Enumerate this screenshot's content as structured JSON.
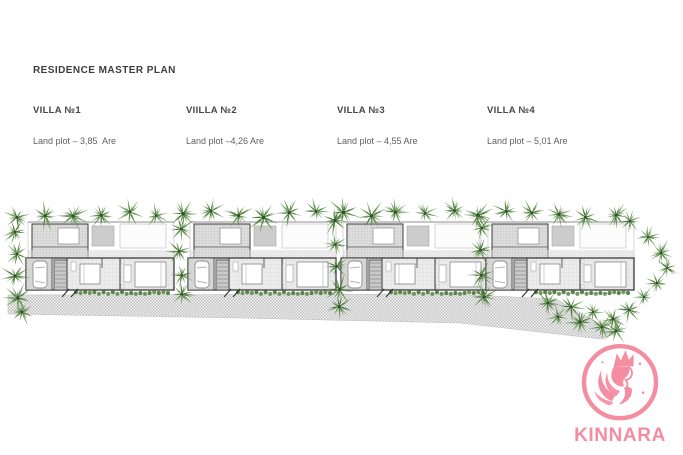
{
  "page": {
    "title": "RESIDENCE MASTER PLAN"
  },
  "villas": [
    {
      "name": "VILLA №1",
      "land_plot": "Land plot – 3,85  Are"
    },
    {
      "name": "VIILLA №2",
      "land_plot": "Land plot –4,26 Are"
    },
    {
      "name": "VILLA №3",
      "land_plot": "Land plot – 4,55 Are"
    },
    {
      "name": "VILLA №4",
      "land_plot": "Land plot – 5,01 Are"
    }
  ],
  "plan": {
    "type": "site-plan",
    "units": 4,
    "features": [
      "palm-trees",
      "hedges",
      "parking-with-car",
      "pool-terrace",
      "driveway-marks",
      "access-road"
    ]
  },
  "logo": {
    "brand": "KINNARA",
    "icon": "kinnara-figure-icon"
  },
  "colors": {
    "tree_green": "#578A41",
    "tree_green_dark": "#3C6B2E",
    "hedge_green": "#5D8D48",
    "hedge_green_dark": "#49763A",
    "wall_dark": "#3A3A3A",
    "floor_gray": "#ECECEC",
    "road_gray": "#C3C3C3",
    "brand_pink": "#F48CA2",
    "title_text": "#3D3D3D",
    "body_text": "#606060"
  }
}
